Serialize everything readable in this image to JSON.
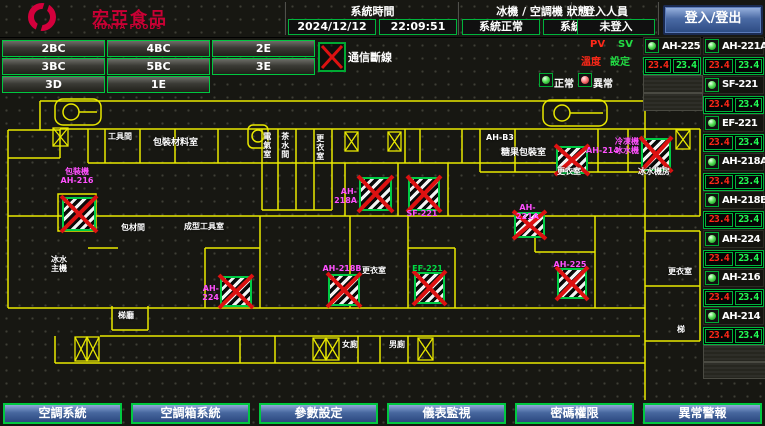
{
  "colors": {
    "accent_green": "#00c840",
    "wall_yellow": "#e8e800",
    "alarm_red": "#dd1111",
    "magenta": "#ff50ff",
    "pv_red": "#ff2818",
    "sv_green": "#22ff55",
    "nav_blue": "#47679e",
    "logo_red": "#c80034"
  },
  "header": {
    "logo_text": "宏亞食品",
    "logo_subtext": "HUNYA FOODS",
    "time_label": "系統時間",
    "date_value": "2024/12/12",
    "time_value": "22:09:51",
    "status_label": "冰機 / 空調機 狀態",
    "chiller_status": "系統正常",
    "ahu_status": "系統正常",
    "login_label": "登入人員",
    "login_status": "未登入",
    "login_button": "登入/登出"
  },
  "floor_buttons": {
    "rows": [
      [
        "2BC",
        "4BC",
        "2E"
      ],
      [
        "3BC",
        "5BC",
        "3E"
      ],
      [
        "3D",
        "1E"
      ]
    ]
  },
  "comm_lost_label": "通信斷線",
  "legend": {
    "pv": "PV",
    "sv": "SV",
    "temp": "溫度",
    "set": "設定",
    "normal": "正常",
    "abnormal": "異常"
  },
  "right_panel": {
    "left_column": [
      {
        "name": "AH-225",
        "pv": "23.4",
        "sv": "23.4",
        "led": "g"
      }
    ],
    "right_column": [
      {
        "name": "AH-221A",
        "pv": "23.4",
        "sv": "23.4",
        "led": "g"
      },
      {
        "name": "SF-221",
        "pv": "23.4",
        "sv": "23.4",
        "led": "g"
      },
      {
        "name": "EF-221",
        "pv": "23.4",
        "sv": "23.4",
        "led": "g"
      },
      {
        "name": "AH-218A",
        "pv": "23.4",
        "sv": "23.4",
        "led": "g"
      },
      {
        "name": "AH-218B",
        "pv": "23.4",
        "sv": "23.4",
        "led": "g"
      },
      {
        "name": "AH-224",
        "pv": "23.4",
        "sv": "23.4",
        "led": "g"
      },
      {
        "name": "AH-216",
        "pv": "23.4",
        "sv": "23.4",
        "led": "g"
      },
      {
        "name": "AH-214",
        "pv": "23.4",
        "sv": "23.4",
        "led": "g"
      }
    ]
  },
  "bottom_nav": [
    "空調系統",
    "空調箱系統",
    "參數設定",
    "儀表監視",
    "密碼權限",
    "異常警報"
  ],
  "floor_plan": {
    "markers": [
      {
        "id": "AH-216",
        "label": "包裝機\nAH-216",
        "x": 62,
        "y": 197,
        "w": 30,
        "h": 30,
        "lx": 52,
        "ly": 167,
        "lw": 50,
        "la": "center",
        "lc": "m"
      },
      {
        "id": "AH-218A",
        "label": "AH-218A",
        "x": 359,
        "y": 177,
        "w": 29,
        "h": 30,
        "lx": 322,
        "ly": 187,
        "lw": 35,
        "la": "right",
        "lc": "m"
      },
      {
        "id": "SF-221",
        "label": "SF-221",
        "x": 408,
        "y": 177,
        "w": 28,
        "h": 30,
        "lx": 404,
        "ly": 209,
        "lw": 36,
        "la": "center",
        "lc": "m"
      },
      {
        "id": "AH-214",
        "label": "AH-214",
        "x": 556,
        "y": 146,
        "w": 28,
        "h": 24,
        "lx": 586,
        "ly": 146,
        "lw": 36,
        "la": "left",
        "lc": "m"
      },
      {
        "id": "冰水機",
        "label": "冷凍機\n冰水機",
        "x": 641,
        "y": 138,
        "w": 26,
        "h": 29,
        "lx": 612,
        "ly": 137,
        "lw": 27,
        "la": "right",
        "lc": "m"
      },
      {
        "id": "AH-221A",
        "label": "AH-221A",
        "x": 514,
        "y": 212,
        "w": 27,
        "h": 22,
        "lx": 508,
        "ly": 203,
        "lw": 39,
        "la": "center",
        "lc": "m"
      },
      {
        "id": "AH-224",
        "label": "AH-224",
        "x": 220,
        "y": 276,
        "w": 28,
        "h": 27,
        "lx": 192,
        "ly": 284,
        "lw": 27,
        "la": "right",
        "lc": "m"
      },
      {
        "id": "AH-218B",
        "label": "AH-218B",
        "x": 328,
        "y": 274,
        "w": 28,
        "h": 28,
        "lx": 322,
        "ly": 264,
        "lw": 40,
        "la": "center",
        "lc": "m"
      },
      {
        "id": "EF-221",
        "label": "EF-221",
        "x": 414,
        "y": 272,
        "w": 27,
        "h": 28,
        "lx": 412,
        "ly": 264,
        "lw": 31,
        "la": "center",
        "lc": "g"
      },
      {
        "id": "AH-225",
        "label": "AH-225",
        "x": 557,
        "y": 268,
        "w": 26,
        "h": 27,
        "lx": 553,
        "ly": 260,
        "lw": 34,
        "la": "center",
        "lc": "m"
      }
    ],
    "room_labels": [
      {
        "t": "工具間",
        "x": 108,
        "y": 133,
        "w": 24
      },
      {
        "t": "包裝材料室",
        "x": 153,
        "y": 139,
        "w": 56,
        "fs": 9
      },
      {
        "t": "電氣室",
        "x": 262,
        "y": 132,
        "v": true
      },
      {
        "t": "茶水間",
        "x": 280,
        "y": 132,
        "v": true
      },
      {
        "t": "更衣室",
        "x": 315,
        "y": 134,
        "v": true
      },
      {
        "t": "AH-B3",
        "x": 486,
        "y": 134,
        "w": 28
      },
      {
        "t": "糖果包裝室",
        "x": 501,
        "y": 149,
        "w": 54,
        "fs": 9
      },
      {
        "t": "更衣室",
        "x": 557,
        "y": 168,
        "w": 28
      },
      {
        "t": "冰水機房",
        "x": 638,
        "y": 168,
        "w": 34
      },
      {
        "t": "包材間",
        "x": 121,
        "y": 224,
        "w": 26
      },
      {
        "t": "成型工具室",
        "x": 184,
        "y": 223,
        "w": 48
      },
      {
        "t": "更衣室",
        "x": 362,
        "y": 267,
        "w": 26
      },
      {
        "t": "冰水\n主機",
        "x": 51,
        "y": 256,
        "w": 18
      },
      {
        "t": "梯廳",
        "x": 118,
        "y": 312,
        "w": 18
      },
      {
        "t": "女廁",
        "x": 342,
        "y": 341,
        "w": 18
      },
      {
        "t": "男廁",
        "x": 389,
        "y": 341,
        "w": 18
      },
      {
        "t": "更衣室",
        "x": 668,
        "y": 268,
        "w": 26
      },
      {
        "t": "梯",
        "x": 677,
        "y": 326,
        "w": 10
      }
    ]
  }
}
